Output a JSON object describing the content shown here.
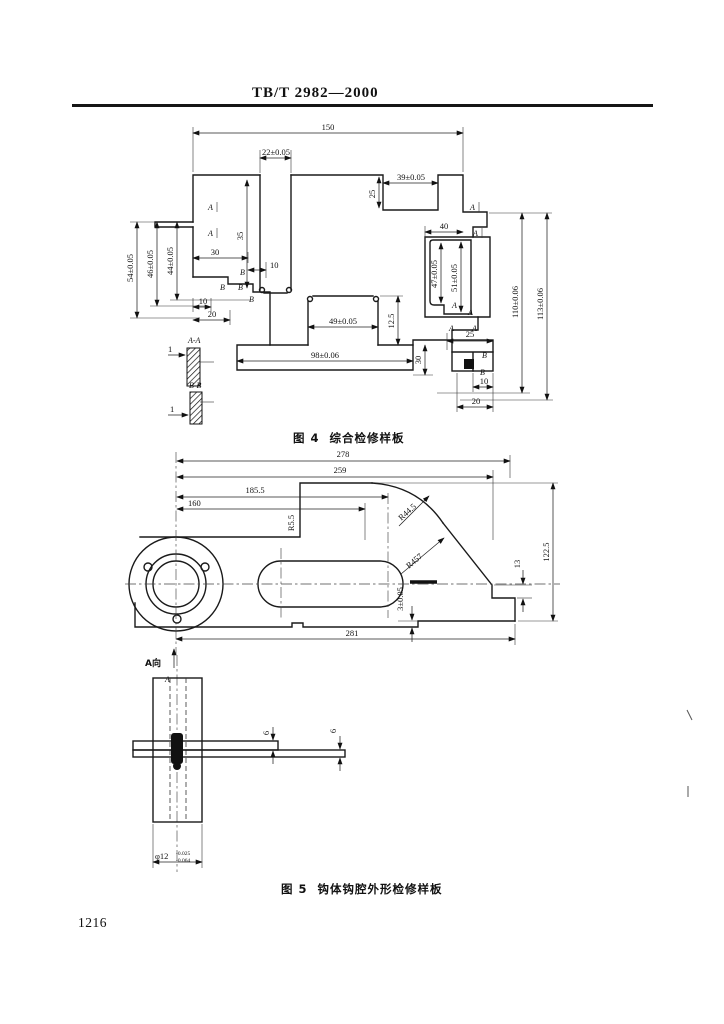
{
  "page": {
    "header_title": "TB/T 2982—2000",
    "page_number": "1216"
  },
  "figure4": {
    "caption": "图 4  综合检修样板",
    "labels": {
      "d150": "150",
      "d22": "22±0.05",
      "d35": "35",
      "d39": "39±0.05",
      "d25a": "25",
      "d40": "40",
      "d54": "54±0.05",
      "d46": "46±0.05",
      "d44": "44±0.05",
      "d30a": "30",
      "d10a": "10",
      "d10b": "10",
      "d20a": "20",
      "d49": "49±0.05",
      "d125": "12.5",
      "d98": "98±0.06",
      "d30b": "30",
      "d47": "47±0.05",
      "d51": "51±0.05",
      "d110": "110±0.06",
      "d113": "113±0.06",
      "d25b": "25",
      "d10c": "10",
      "d20b": "20",
      "secAA": "A-A",
      "secBB": "B-B",
      "d1a": "1",
      "d1b": "1",
      "markA": "A",
      "markB": "B"
    }
  },
  "figure5": {
    "caption": "图 5  钩体钩腔外形检修样板",
    "labels": {
      "d278": "278",
      "d259": "259",
      "d1855": "185.5",
      "d160": "160",
      "r55": "R5.5",
      "r445": "R44.5",
      "r457": "R457",
      "d13": "13",
      "d1225": "122.5",
      "d3": "3±0.05",
      "d281": "281",
      "viewA": "A向",
      "markA": "A",
      "d6a": "6",
      "d6b": "6",
      "phi": "φ12",
      "tol_up": "-0.025",
      "tol_dn": "-0.064"
    }
  }
}
